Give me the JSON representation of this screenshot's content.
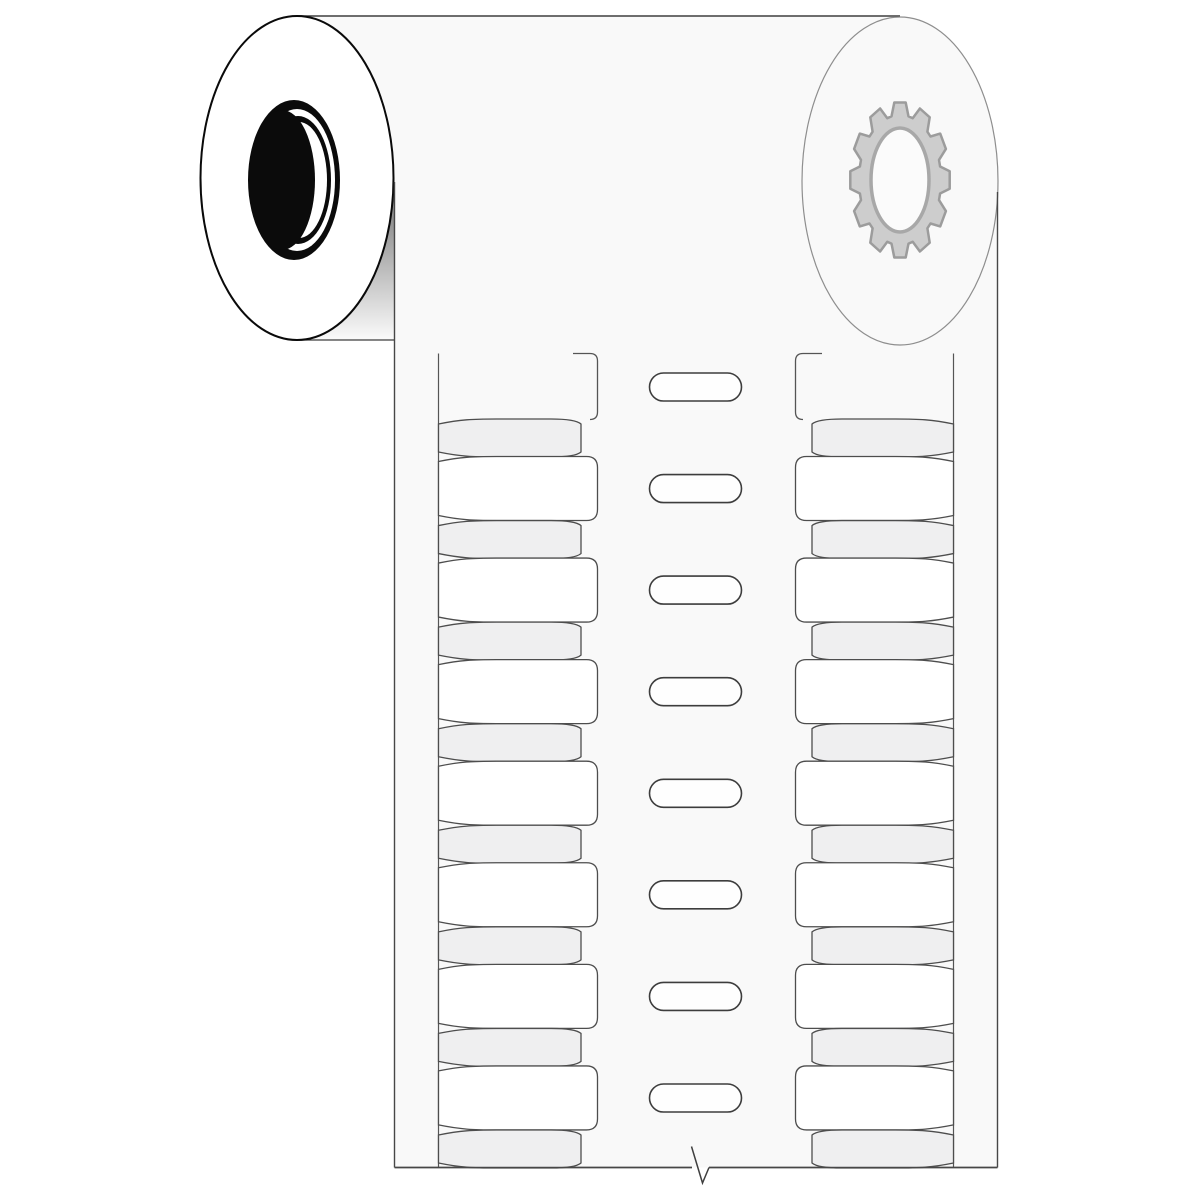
{
  "illustration": {
    "title": "Wire-marker label roll",
    "description": "Line-art illustration of a label roll with a liner strip of two label columns and central sprocket feed holes",
    "parts": {
      "roll": "media roll",
      "left_end": "roll end with black tube core",
      "right_end": "roll end with gear hub",
      "strip": "liner strip with label slots",
      "break_mark": "continuation break symbol on bottom edge"
    }
  },
  "colors": {
    "page_bg": "#ffffff",
    "media_fill": "#f9f9f9",
    "white_label_fill": "#ffffff",
    "gray_label_fill": "#efeff0",
    "label_outline": "#4d4d4d",
    "slot_outline": "#555555",
    "strip_edge": "#474747",
    "pill_fill": "#fefefe",
    "pill_outline": "#3d3d3d",
    "roll_edge": "#3f3f3f",
    "left_end_fill": "#ffffff",
    "left_end_stroke": "#0a0a0a",
    "core_black": "#0b0b0b",
    "core_white": "#ffffff",
    "right_end_stroke": "#8e8e8e",
    "gear_fill": "#cdcdcd",
    "gear_stroke": "#9c9c9c",
    "gear_hub_fill": "#fbfbfb",
    "gear_hub_stroke": "#a8a8a8",
    "shadow_color": "#000000"
  },
  "roll": {
    "gear_teeth": 12
  },
  "strip": {
    "columns": 2,
    "gray_labels_per_column": 8,
    "white_labels_per_column": 7,
    "sprocket_hole_count": 8,
    "has_break_mark": true
  }
}
